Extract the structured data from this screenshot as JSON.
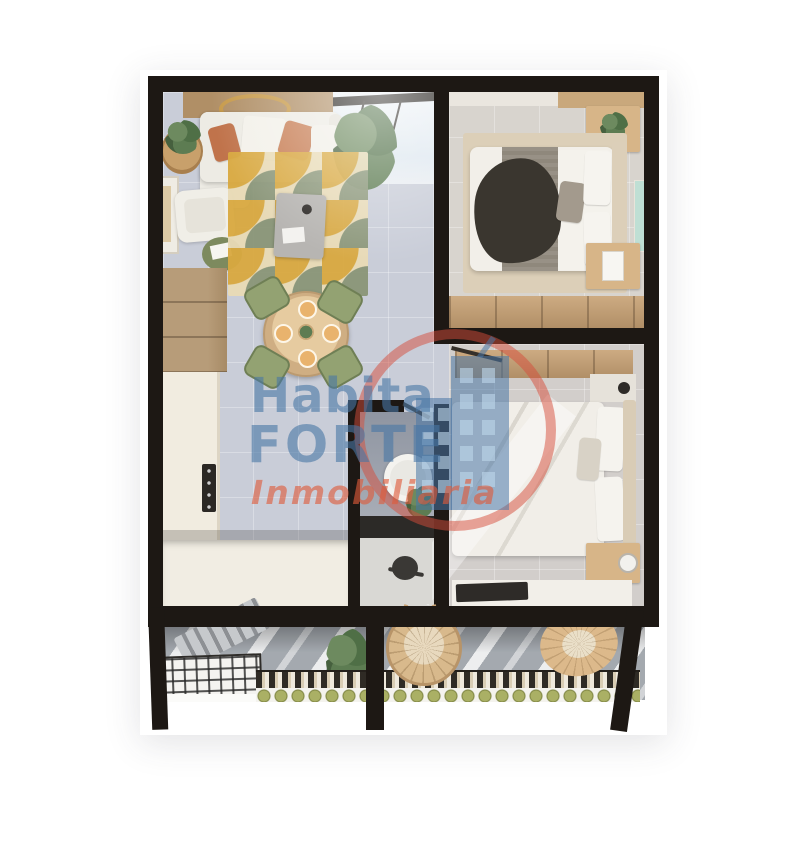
{
  "watermark": {
    "line1": "Habita",
    "line2": "FORTE",
    "line3": "Inmobiliaria",
    "logo_icon": "buildings-in-circle-icon"
  },
  "palette": {
    "background": "#ffffff",
    "wall": "#1d1814",
    "living_floor": "#c9cdd8",
    "bedroom1_floor": "#d8d4ce",
    "bedroom2_floor": "#d2cecb",
    "bathroom_floor": "#d9d8d4",
    "bathroom_wall": "#9aa0ab",
    "vanity_dark": "#2c2a27",
    "wood_light": "#c9a87c",
    "wood_cabinet": "#b79c79",
    "counter": "#f1ece0",
    "sofa": "#edebe4",
    "pillow_terracotta": "#c0734b",
    "rug_base": "#e9dbb6",
    "rug_mustard": "#d9a940",
    "rug_sage": "#8a9678",
    "plant_green": "#4f6f46",
    "chair_green": "#93a272",
    "bed_linen": "#f2efe9",
    "blanket_gray": "#8f887c",
    "throw_dark": "#3a362f",
    "headboard": "#dccfb9",
    "balcony_floor": "#a4a9af",
    "wicker": "#d8b98c",
    "planter_green": "#9aa05a",
    "watermark_blue": "#4876a5",
    "watermark_red": "#de5a3a"
  }
}
